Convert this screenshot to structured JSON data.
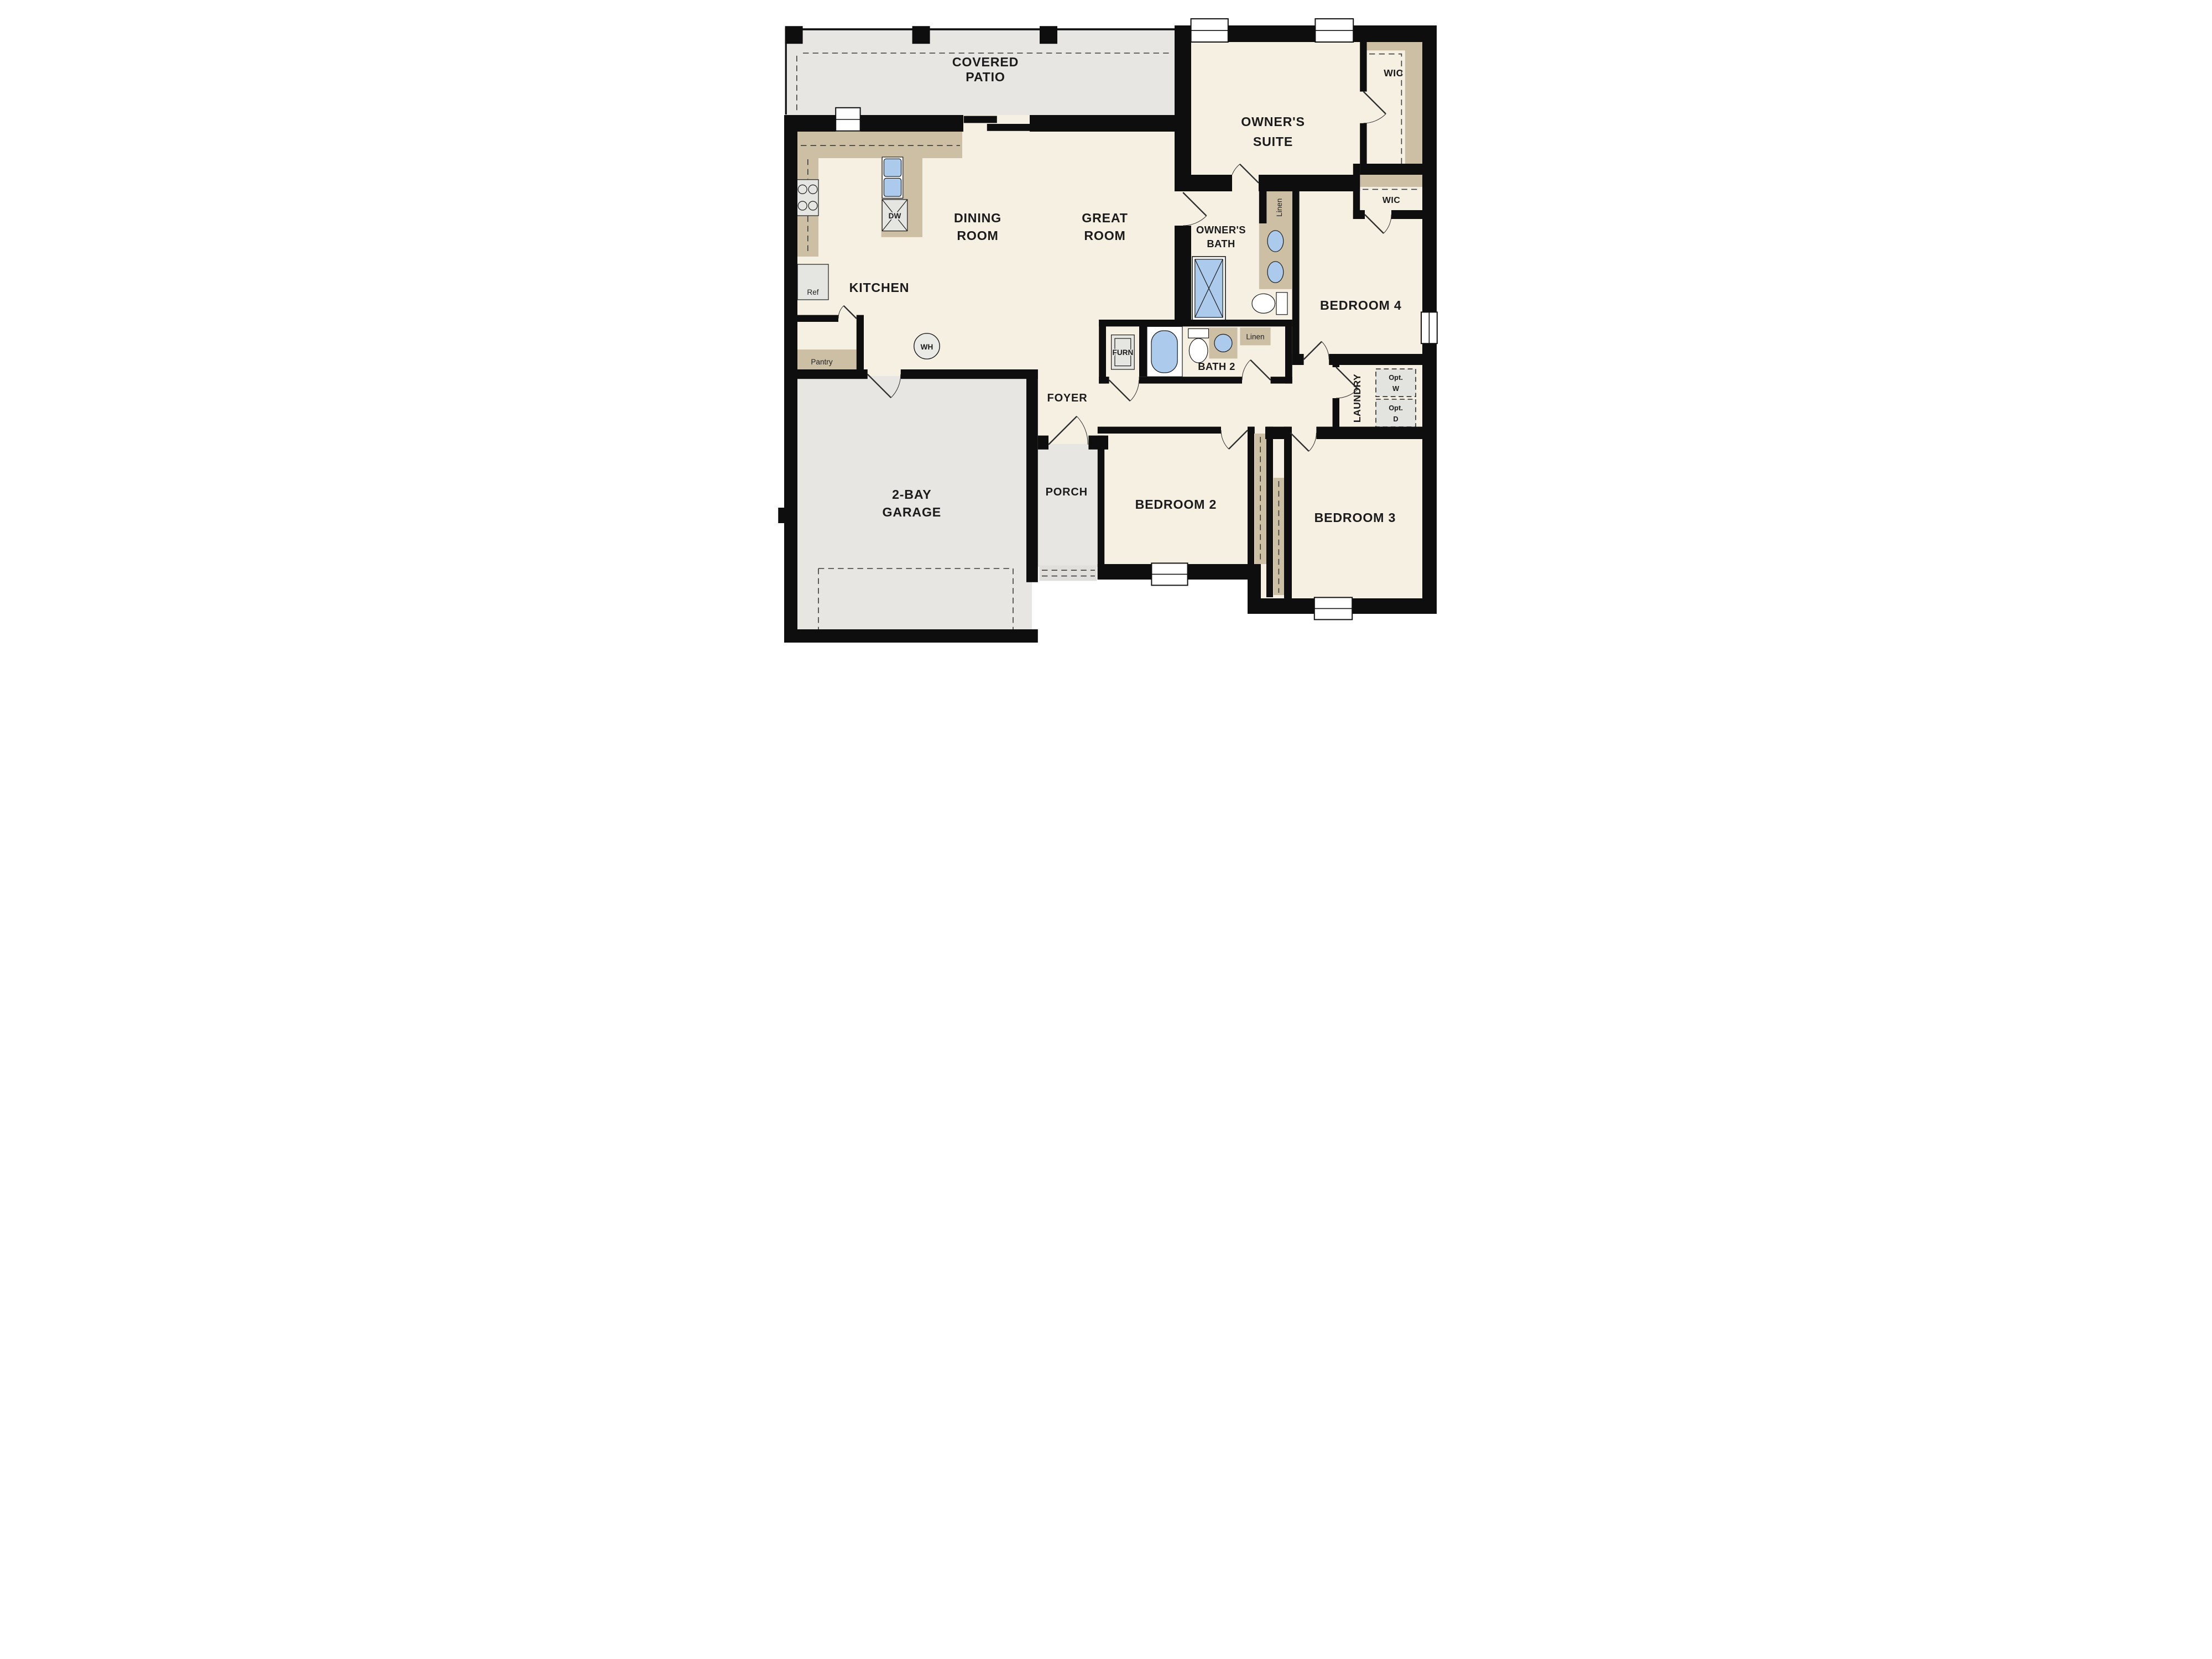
{
  "plan_title": "Single-story floor plan",
  "palette": {
    "wall": "#0e0e0e",
    "interior_floor": "#f6f0e3",
    "exterior_floor": "#e7e6e2",
    "cabinet_tan": "#cdbfa4",
    "fixture_blue": "#abcaec",
    "appliance_gray": "#e5e5e2",
    "background": "#ffffff"
  },
  "rooms": {
    "covered_patio": {
      "lines": [
        "COVERED",
        "PATIO"
      ]
    },
    "owners_suite": {
      "lines": [
        "OWNER'S",
        "SUITE"
      ]
    },
    "dining_room": {
      "lines": [
        "DINING",
        "ROOM"
      ]
    },
    "great_room": {
      "lines": [
        "GREAT",
        "ROOM"
      ]
    },
    "kitchen": {
      "label": "KITCHEN"
    },
    "owners_bath": {
      "lines": [
        "OWNER'S",
        "BATH"
      ]
    },
    "bath_2": {
      "label": "BATH 2"
    },
    "bedroom_2": {
      "label": "BEDROOM 2"
    },
    "bedroom_3": {
      "label": "BEDROOM 3"
    },
    "bedroom_4": {
      "label": "BEDROOM 4"
    },
    "laundry": {
      "label": "LAUNDRY"
    },
    "foyer": {
      "label": "FOYER"
    },
    "porch": {
      "label": "PORCH"
    },
    "garage": {
      "lines": [
        "2-BAY",
        "GARAGE"
      ]
    },
    "wic_suite": {
      "label": "WIC"
    },
    "wic_bed4": {
      "label": "WIC"
    },
    "pantry": {
      "label": "Pantry"
    }
  },
  "fixtures": {
    "refrigerator": "Ref",
    "dishwasher": "DW",
    "water_heater": "WH",
    "furnace": "FURN",
    "linen_owners": "Linen",
    "linen_hall": "Linen",
    "optional_washer": {
      "lines": [
        "Opt.",
        "W"
      ]
    },
    "optional_dryer": {
      "lines": [
        "Opt.",
        "D"
      ]
    }
  }
}
